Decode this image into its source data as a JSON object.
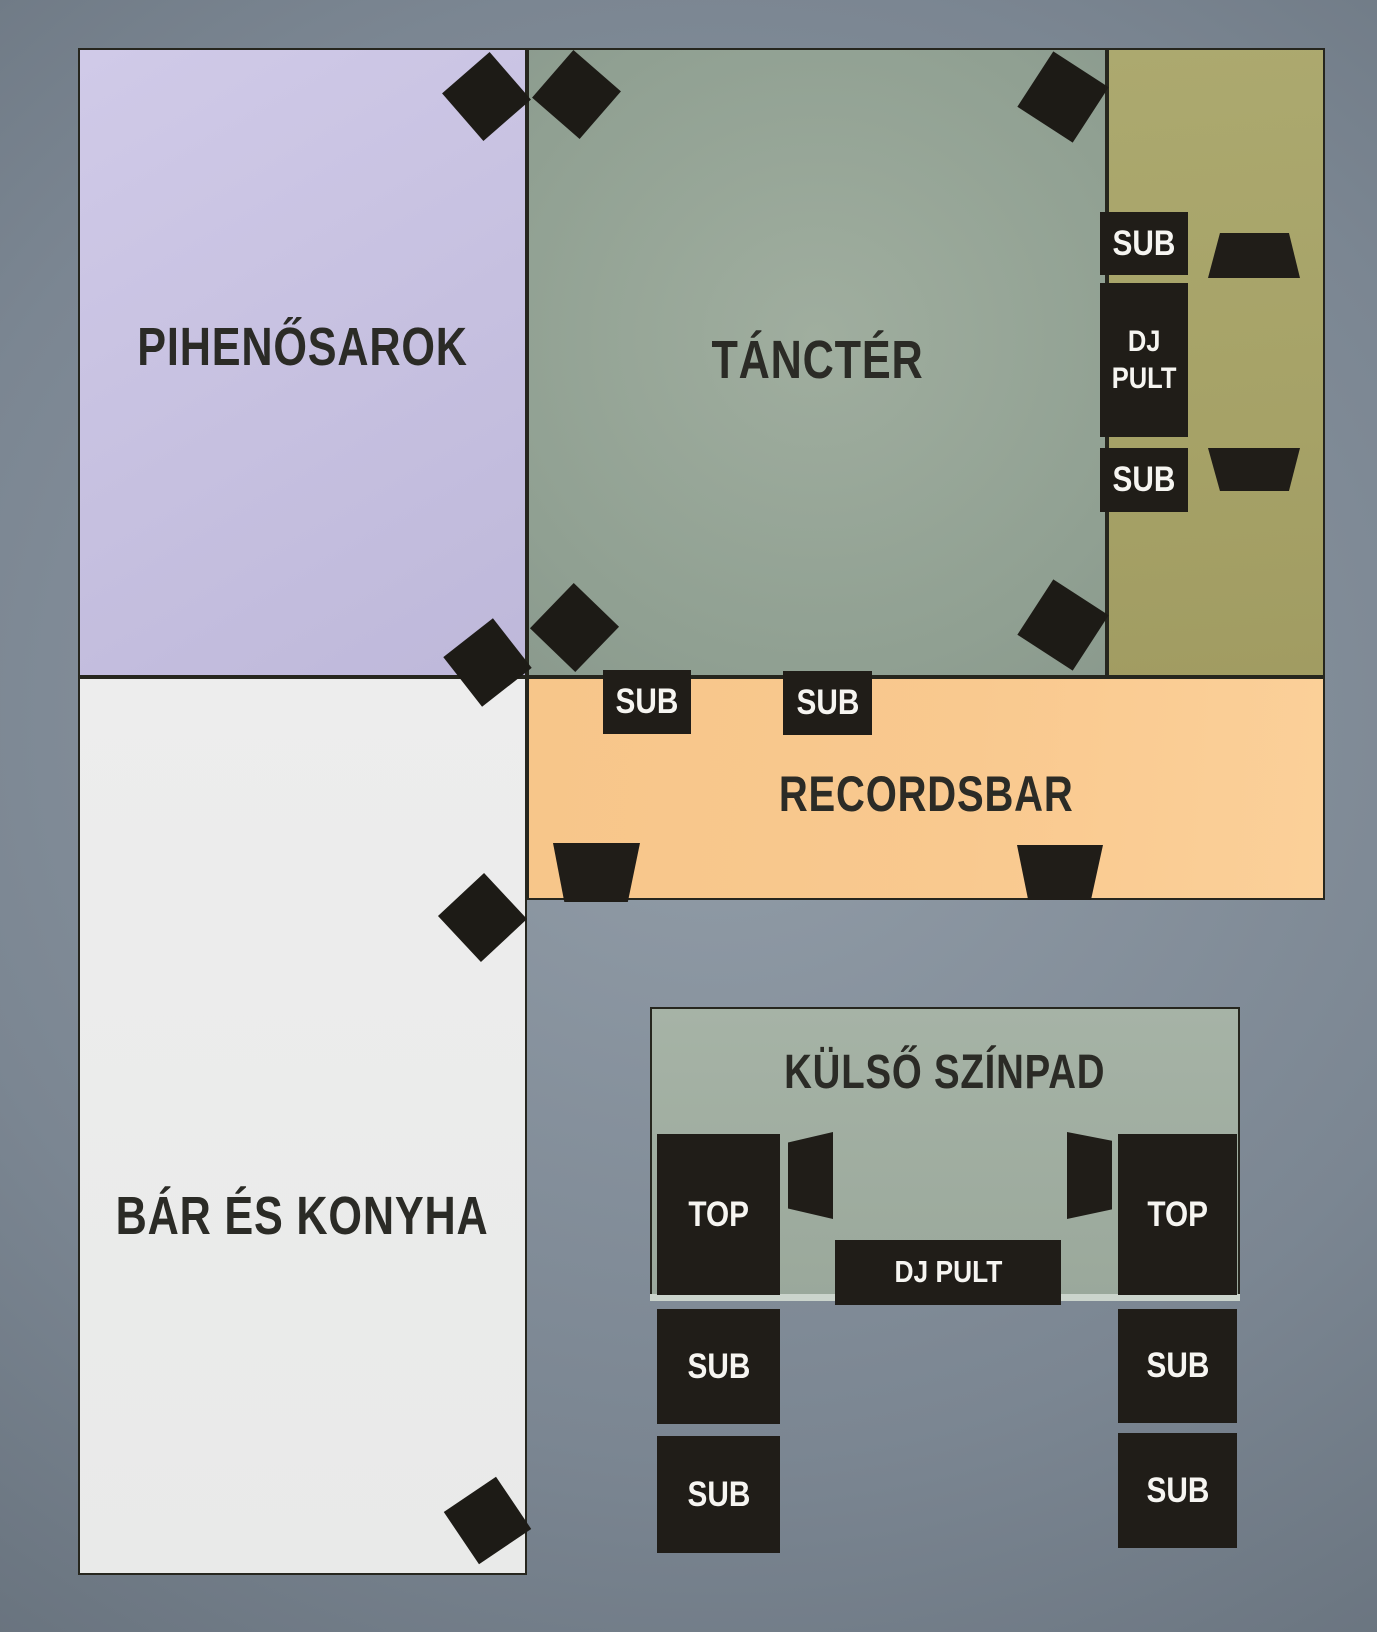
{
  "rooms": {
    "pihenosarok": {
      "label": "PIHENŐSAROK",
      "color": "#c7c1e2"
    },
    "tancter": {
      "label": "TÁNCTÉR",
      "color": "#93a294"
    },
    "dj_corner": {
      "color": "#a6a267"
    },
    "recordsbar": {
      "label": "RECORDSBAR",
      "color": "#f9c98f"
    },
    "bar_kitchen": {
      "label": "BÁR ÉS KONYHA",
      "color": "#ebecec"
    },
    "outdoor_stage": {
      "label": "KÜLSŐ SZÍNPAD",
      "color": "#9fad9f"
    }
  },
  "equipment": {
    "sub_label": "SUB",
    "top_label": "TOP",
    "dj_pult_label": "DJ PULT",
    "dj_line1": "DJ",
    "dj_line2": "PULT"
  },
  "colors": {
    "background_slate": "#7b8692",
    "speaker_black": "#201d18",
    "room_border": "#26261e",
    "room_label_text": "#2b2b26",
    "equipment_text": "#f6f5f1",
    "stage_front_edge": "#cbd4cc"
  }
}
